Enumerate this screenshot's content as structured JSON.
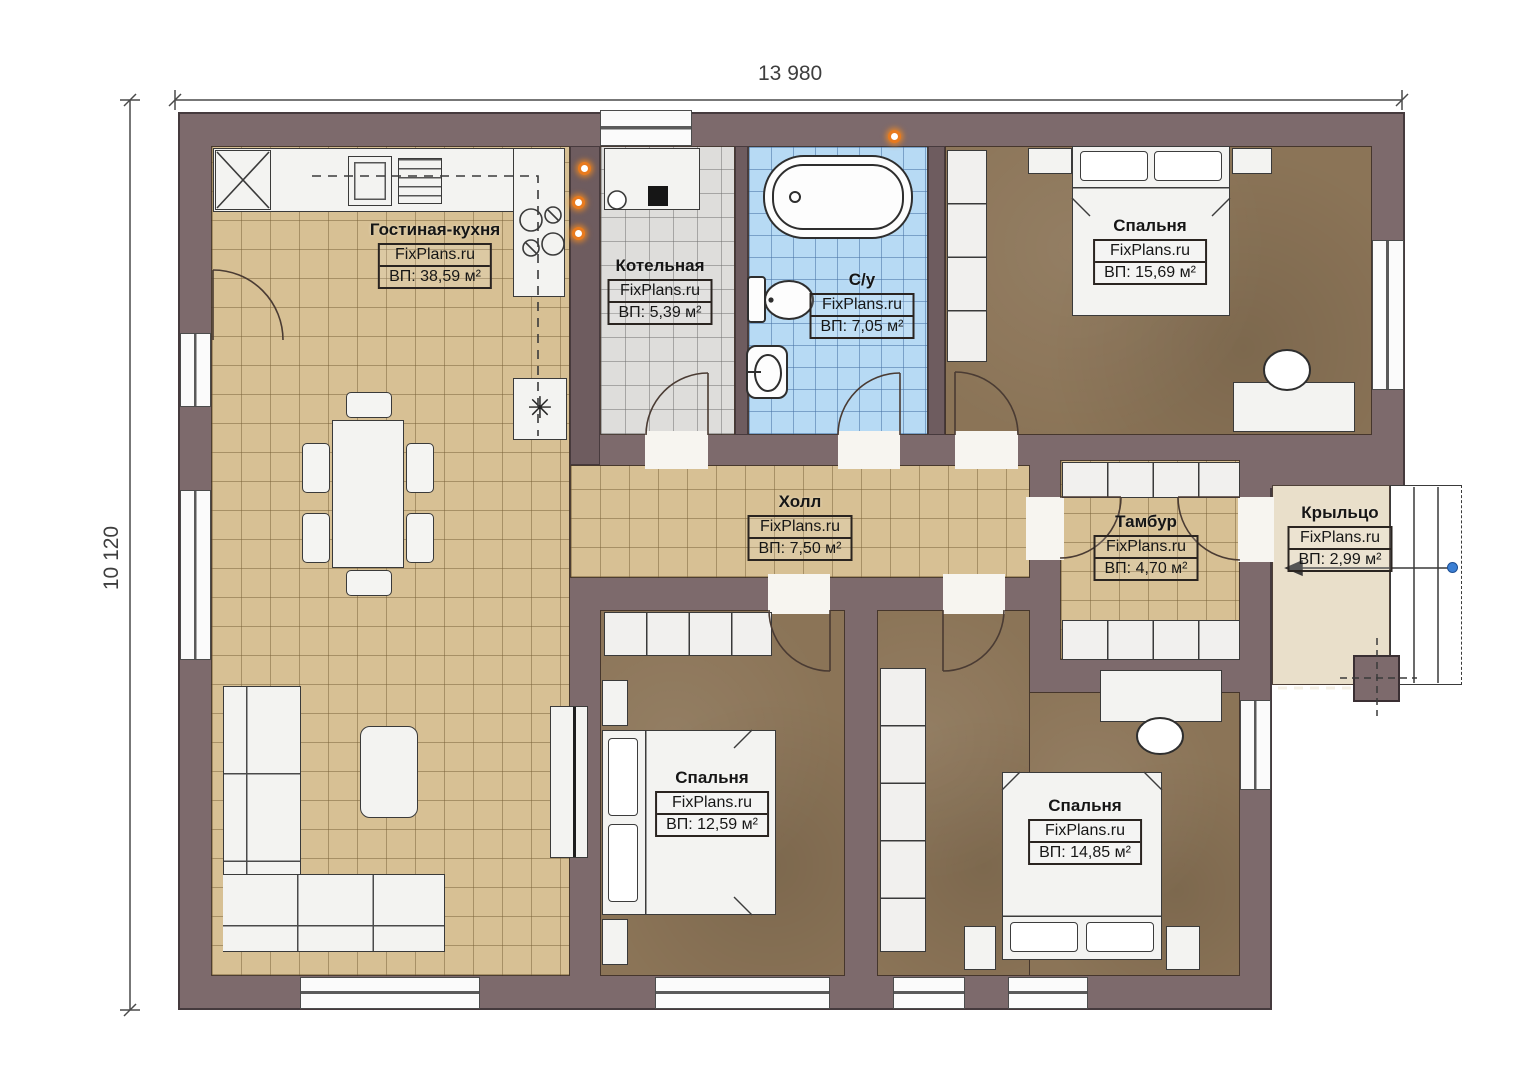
{
  "plan": {
    "dimensions": {
      "width_label": "13 980",
      "height_label": "10 120"
    },
    "brand": "FixPlans.ru",
    "symbols": {
      "vent": "✳"
    },
    "rooms": [
      {
        "id": "living-kitchen",
        "name": "Гостиная-кухня",
        "brand": "FixPlans.ru",
        "area": "ВП: 38,59 м²"
      },
      {
        "id": "boiler-room",
        "name": "Котельная",
        "brand": "FixPlans.ru",
        "area": "ВП: 5,39 м²"
      },
      {
        "id": "bathroom",
        "name": "С/у",
        "brand": "FixPlans.ru",
        "area": "ВП: 7,05 м²"
      },
      {
        "id": "bedroom-top-right",
        "name": "Спальня",
        "brand": "FixPlans.ru",
        "area": "ВП: 15,69 м²"
      },
      {
        "id": "hall",
        "name": "Холл",
        "brand": "FixPlans.ru",
        "area": "ВП: 7,50 м²"
      },
      {
        "id": "tambour",
        "name": "Тамбур",
        "brand": "FixPlans.ru",
        "area": "ВП: 4,70 м²"
      },
      {
        "id": "porch",
        "name": "Крыльцо",
        "brand": "FixPlans.ru",
        "area": "ВП: 2,99 м²"
      },
      {
        "id": "bedroom-bottom-middle",
        "name": "Спальня",
        "brand": "FixPlans.ru",
        "area": "ВП: 12,59 м²"
      },
      {
        "id": "bedroom-bottom-right",
        "name": "Спальня",
        "brand": "FixPlans.ru",
        "area": "ВП: 14,85 м²"
      }
    ],
    "colors": {
      "wall": "#7d6a6c",
      "floor_tile_tan": "#d7c094",
      "floor_tile_gray": "#dedddb",
      "floor_tile_blue": "#b7daf4",
      "floor_bedroom_brown": "#8b7457",
      "porch": "#e9dfca",
      "utility_marker_orange": "#e87a1e",
      "handle_blue": "#3b7fd4"
    }
  }
}
